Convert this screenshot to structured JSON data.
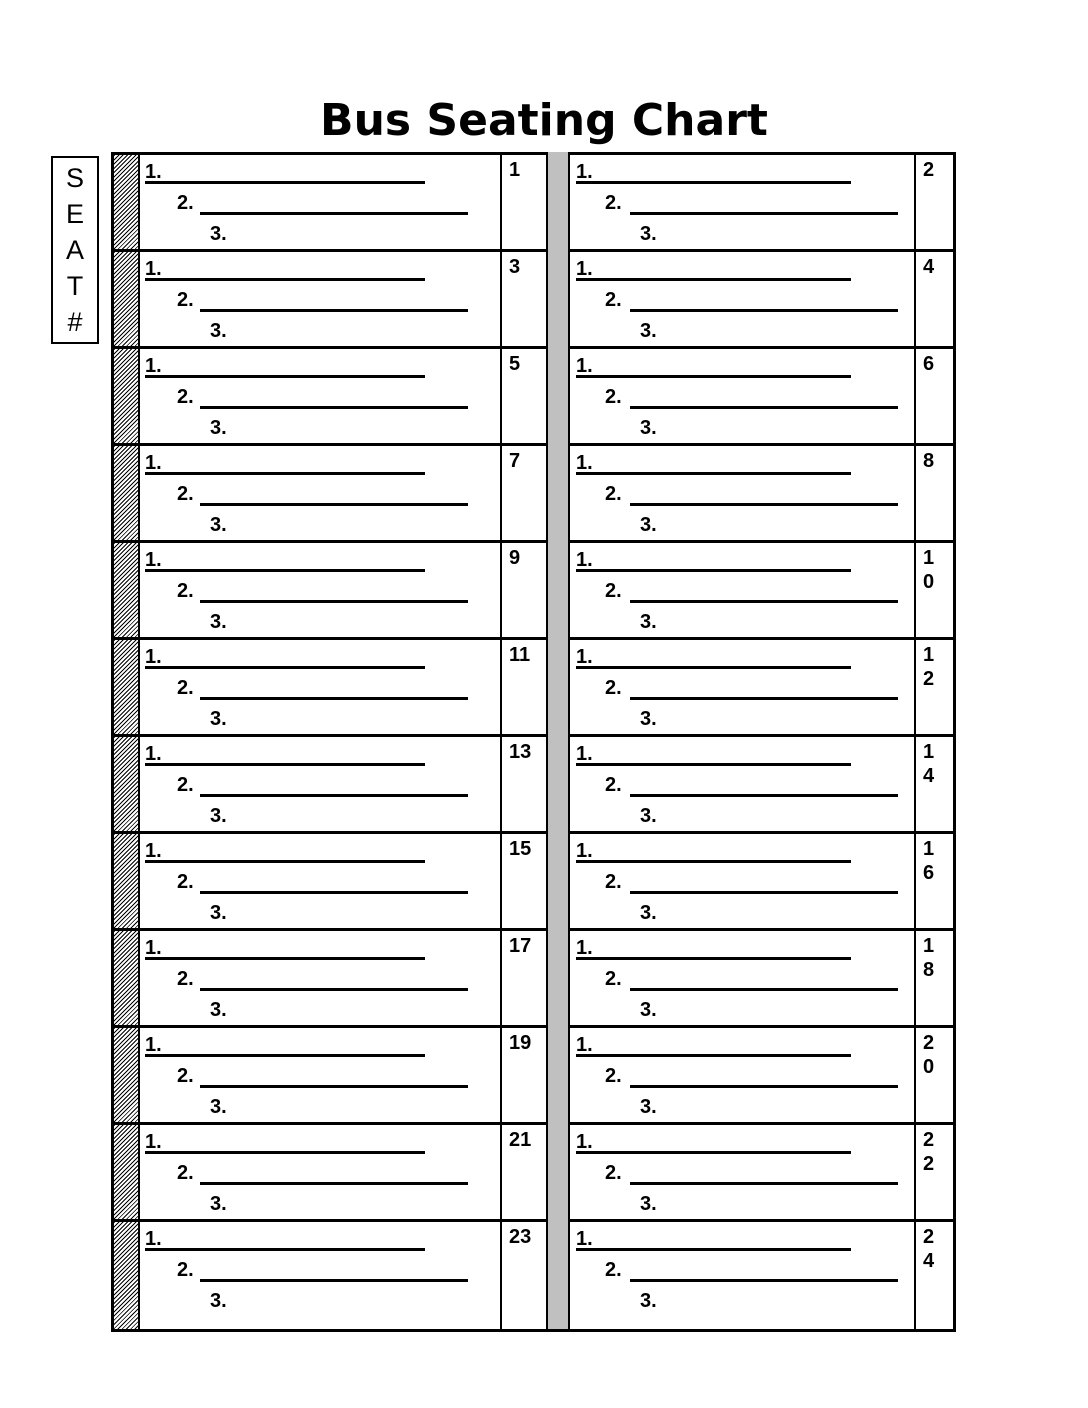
{
  "title": "Bus Seating Chart",
  "seat_legend": "SEAT#",
  "block_labels": {
    "line1": "1.",
    "line2": "2.",
    "line3": "3."
  },
  "rows": [
    {
      "left_seat": "1",
      "right_seat": "2"
    },
    {
      "left_seat": "3",
      "right_seat": "4"
    },
    {
      "left_seat": "5",
      "right_seat": "6"
    },
    {
      "left_seat": "7",
      "right_seat": "8"
    },
    {
      "left_seat": "9",
      "right_seat": "10"
    },
    {
      "left_seat": "11",
      "right_seat": "12"
    },
    {
      "left_seat": "13",
      "right_seat": "14"
    },
    {
      "left_seat": "15",
      "right_seat": "16"
    },
    {
      "left_seat": "17",
      "right_seat": "18"
    },
    {
      "left_seat": "19",
      "right_seat": "20"
    },
    {
      "left_seat": "21",
      "right_seat": "22"
    },
    {
      "left_seat": "23",
      "right_seat": "24"
    }
  ],
  "colors": {
    "ink": "#000000",
    "paper": "#ffffff",
    "aisle": "#c0c0c0"
  }
}
